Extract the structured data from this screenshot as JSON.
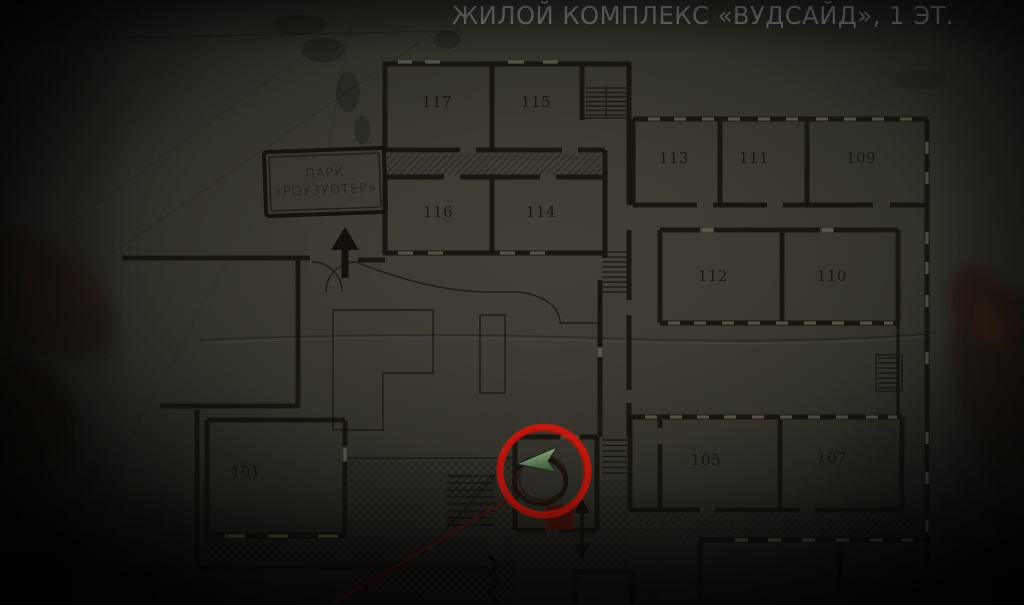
{
  "header": {
    "title": "ЖИЛОЙ КОМПЛЕКС «ВУДСАЙД», 1 ЭТ."
  },
  "park": {
    "line1": "ПАРК",
    "line2": "«РОУЗУОТЕР»"
  },
  "rooms": [
    {
      "number": "117"
    },
    {
      "number": "115"
    },
    {
      "number": "116"
    },
    {
      "number": "114"
    },
    {
      "number": "113"
    },
    {
      "number": "111"
    },
    {
      "number": "109"
    },
    {
      "number": "112"
    },
    {
      "number": "110"
    },
    {
      "number": "105"
    },
    {
      "number": "107"
    },
    {
      "number": "101"
    },
    {
      "number": "104"
    },
    {
      "number": "106"
    },
    {
      "number": "108"
    }
  ],
  "markers": {
    "player_position": "green-arrow-player-marker",
    "objective": "red-circle-annotation",
    "hand_drawn_note": "ink-circle",
    "save_point": "dark-red-square",
    "elevator": "up-down-arrow",
    "park_exit": "up-arrow",
    "blocked_path": "zigzag-mark"
  },
  "colors": {
    "paper": "#3a3830",
    "ink": "#16130d",
    "annotation_red": "#c8170c",
    "player_green": "#7ea879",
    "save_red": "#47120c",
    "title_gray": "#7b7e80"
  }
}
